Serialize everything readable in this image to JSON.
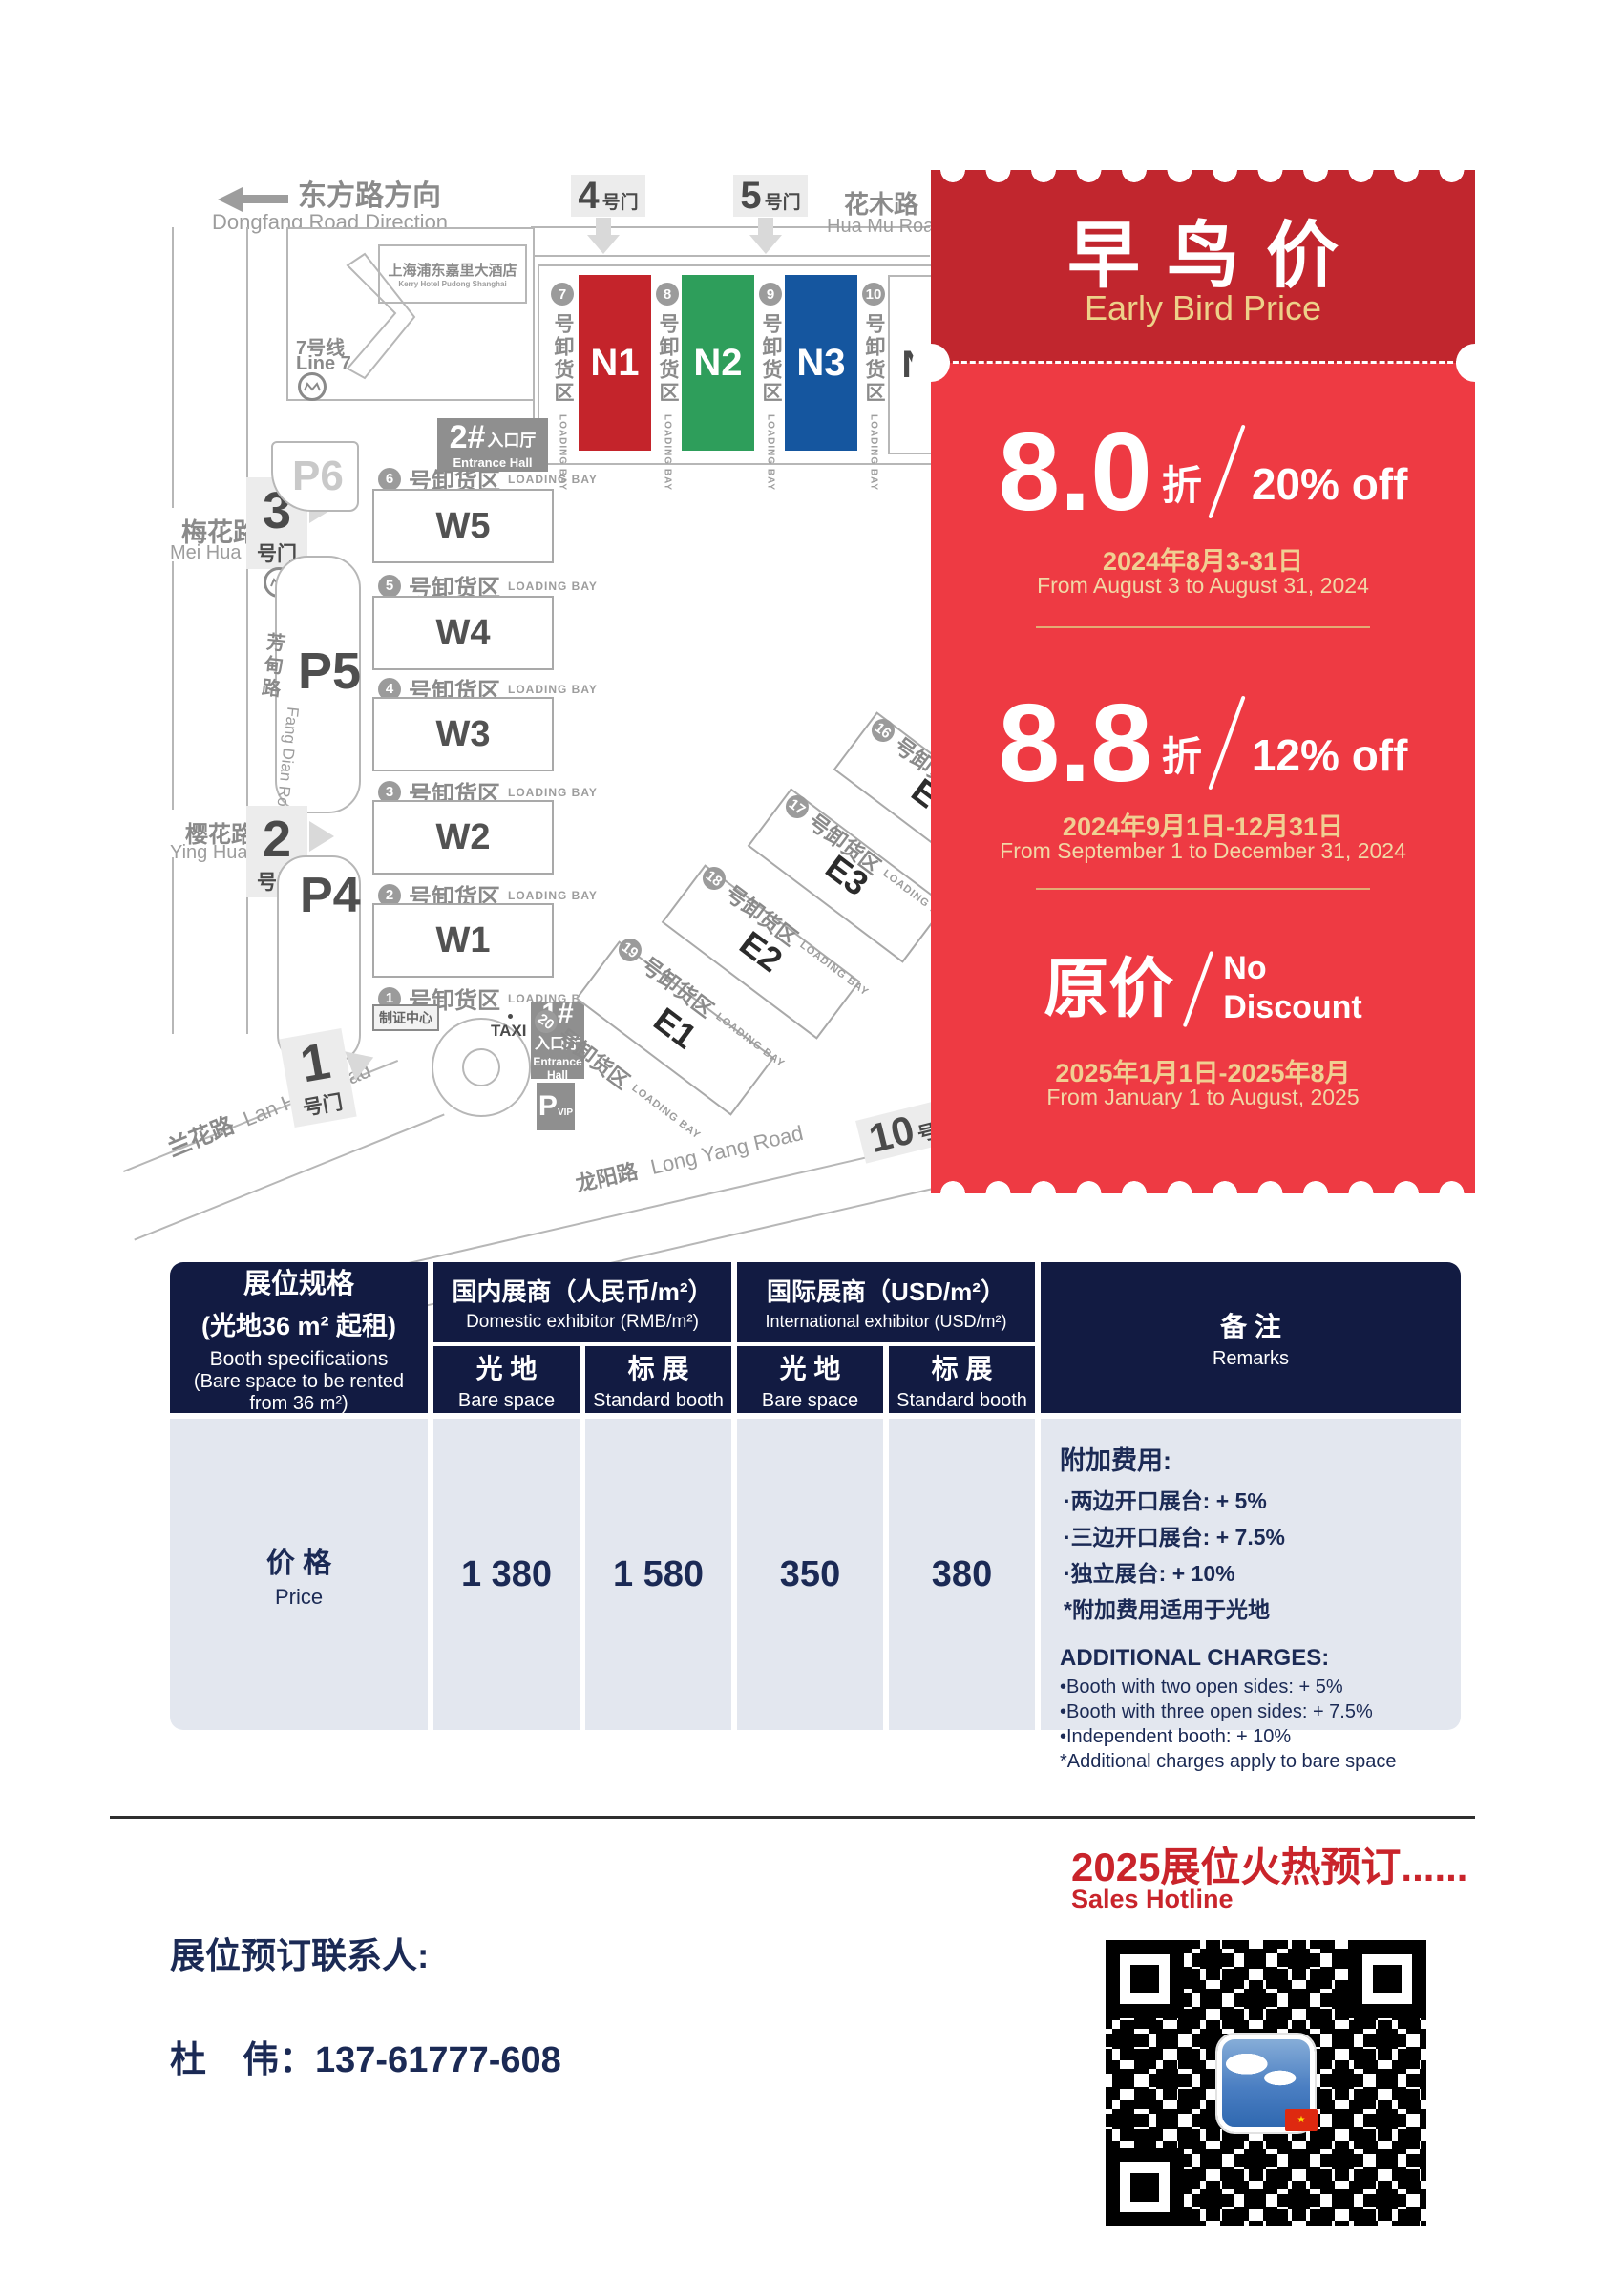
{
  "map": {
    "direction_cn": "东方路方向",
    "direction_en": "Dongfang Road Direction",
    "hotel_cn": "上海浦东嘉里大酒店",
    "hotel_en": "Kerry Hotel Pudong Shanghai",
    "line7_cn": "7号线",
    "line7_en": "Line 7",
    "huamu_cn": "花木路",
    "huamu_en": "Hua Mu Road",
    "meihua_cn": "梅花路",
    "meihua_en": "Mei Hua Road",
    "fangdian_cn": "芳甸路",
    "fangdian_en": "Fang Dian Road",
    "yinghua_cn": "樱花路",
    "yinghua_en": "Ying Hua Road",
    "lanhua_cn": "兰花路",
    "lanhua_en": "Lan Hua Road",
    "longyang_cn": "龙阳路",
    "longyang_en": "Long Yang Road",
    "gate_suffix": "号门",
    "gates": {
      "g1": "1",
      "g2": "2",
      "g3": "3",
      "g4": "4",
      "g5": "5",
      "g10": "10"
    },
    "parking": {
      "p4": "P4",
      "p5": "P5",
      "p6": "P6",
      "pvip": "P",
      "pvip_sub": "VIP"
    },
    "entrance1_num": "1#",
    "entrance2_num": "2#",
    "entrance_cn": "入口厅",
    "entrance_en": "Entrance Hall",
    "entrance_en1": "Entrance",
    "entrance_en2": "Hall",
    "badge_center": "制证中心",
    "taxi": "TAXI",
    "bay_cn": "号卸货区",
    "bay_en": "LOADING BAY",
    "n_halls": [
      "N1",
      "N2",
      "N3",
      "N4"
    ],
    "n_bays": [
      "7",
      "8",
      "9",
      "10"
    ],
    "w_halls": [
      "W5",
      "W4",
      "W3",
      "W2",
      "W1"
    ],
    "w_bays": [
      "6",
      "5",
      "4",
      "3",
      "2",
      "1"
    ],
    "e_halls": [
      "E4",
      "E3",
      "E2",
      "E1"
    ],
    "e_bays": [
      "16",
      "17",
      "18",
      "19",
      "20"
    ]
  },
  "ticket": {
    "title_cn": "早鸟价",
    "title_en": "Early Bird Price",
    "tiers": [
      {
        "discount": "8.0",
        "unit": "折",
        "off": "20% off",
        "date_cn": "2024年8月3-31日",
        "date_en": "From August 3 to August 31, 2024"
      },
      {
        "discount": "8.8",
        "unit": "折",
        "off": "12% off",
        "date_cn": "2024年9月1日-12月31日",
        "date_en": "From September 1 to December 31, 2024"
      },
      {
        "discount": "原价",
        "off1": "No",
        "off2": "Discount",
        "date_cn": "2025年1月1日-2025年8月",
        "date_en": "From January 1 to August, 2025"
      }
    ]
  },
  "table": {
    "spec_cn1": "展位规格",
    "spec_cn2": "(光地36 m² 起租)",
    "spec_en1": "Booth specifications",
    "spec_en2": "(Bare space to be rented",
    "spec_en3": "from 36 m²)",
    "domestic_cn": "国内展商（人民币/m²）",
    "domestic_en": "Domestic exhibitor (RMB/m²)",
    "intl_cn": "国际展商（USD/m²）",
    "intl_en": "International exhibitor (USD/m²)",
    "bare_cn": "光 地",
    "bare_en": "Bare space",
    "std_cn": "标 展",
    "std_en": "Standard booth",
    "remarks_cn": "备 注",
    "remarks_en": "Remarks",
    "price_cn": "价 格",
    "price_en": "Price",
    "prices": [
      "1 380",
      "1 580",
      "350",
      "380"
    ],
    "remarks": {
      "cn_title": "附加费用:",
      "cn_items": [
        "·两边开口展台: + 5%",
        "·三边开口展台: + 7.5%",
        "·独立展台: + 10%",
        "*附加费用适用于光地"
      ],
      "en_title": "ADDITIONAL CHARGES:",
      "en_items": [
        "•Booth with two open sides: + 5%",
        "•Booth with three open sides: + 7.5%",
        "•Independent booth: + 10%",
        "*Additional charges apply to bare space"
      ]
    }
  },
  "footer": {
    "hotline_cn": "2025展位火热预订......",
    "hotline_en": "Sales Hotline",
    "contact_label": "展位预订联系人:",
    "contact_phone": "杜　伟：137-61777-608"
  },
  "colors": {
    "ticket_header_red": "#C1262E",
    "ticket_body_red": "#EE3A43",
    "gold_text": "#EFD196",
    "table_header_navy": "#121B42",
    "table_body_bg": "#E3E7EF",
    "navy_text": "#1B2A55",
    "hotline_red": "#C9242B",
    "hall_n1_red": "#C4242B",
    "hall_n2_green": "#2E9E5B",
    "hall_n3_blue": "#15569F"
  }
}
